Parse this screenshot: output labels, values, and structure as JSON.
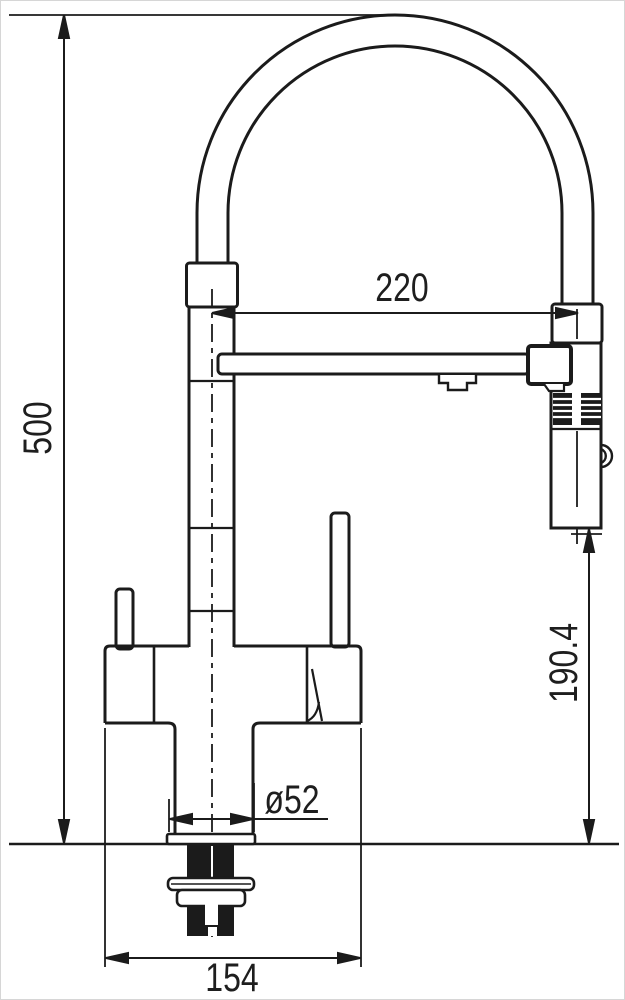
{
  "drawing": {
    "type": "faucet-dimension-drawing",
    "background_color": "#ffffff",
    "line_color": "#1b1b1b"
  },
  "dimensions": {
    "overall_height": "500",
    "spout_reach": "220",
    "outlet_height": "190.4",
    "base_diameter": "ø52",
    "base_width": "154"
  }
}
